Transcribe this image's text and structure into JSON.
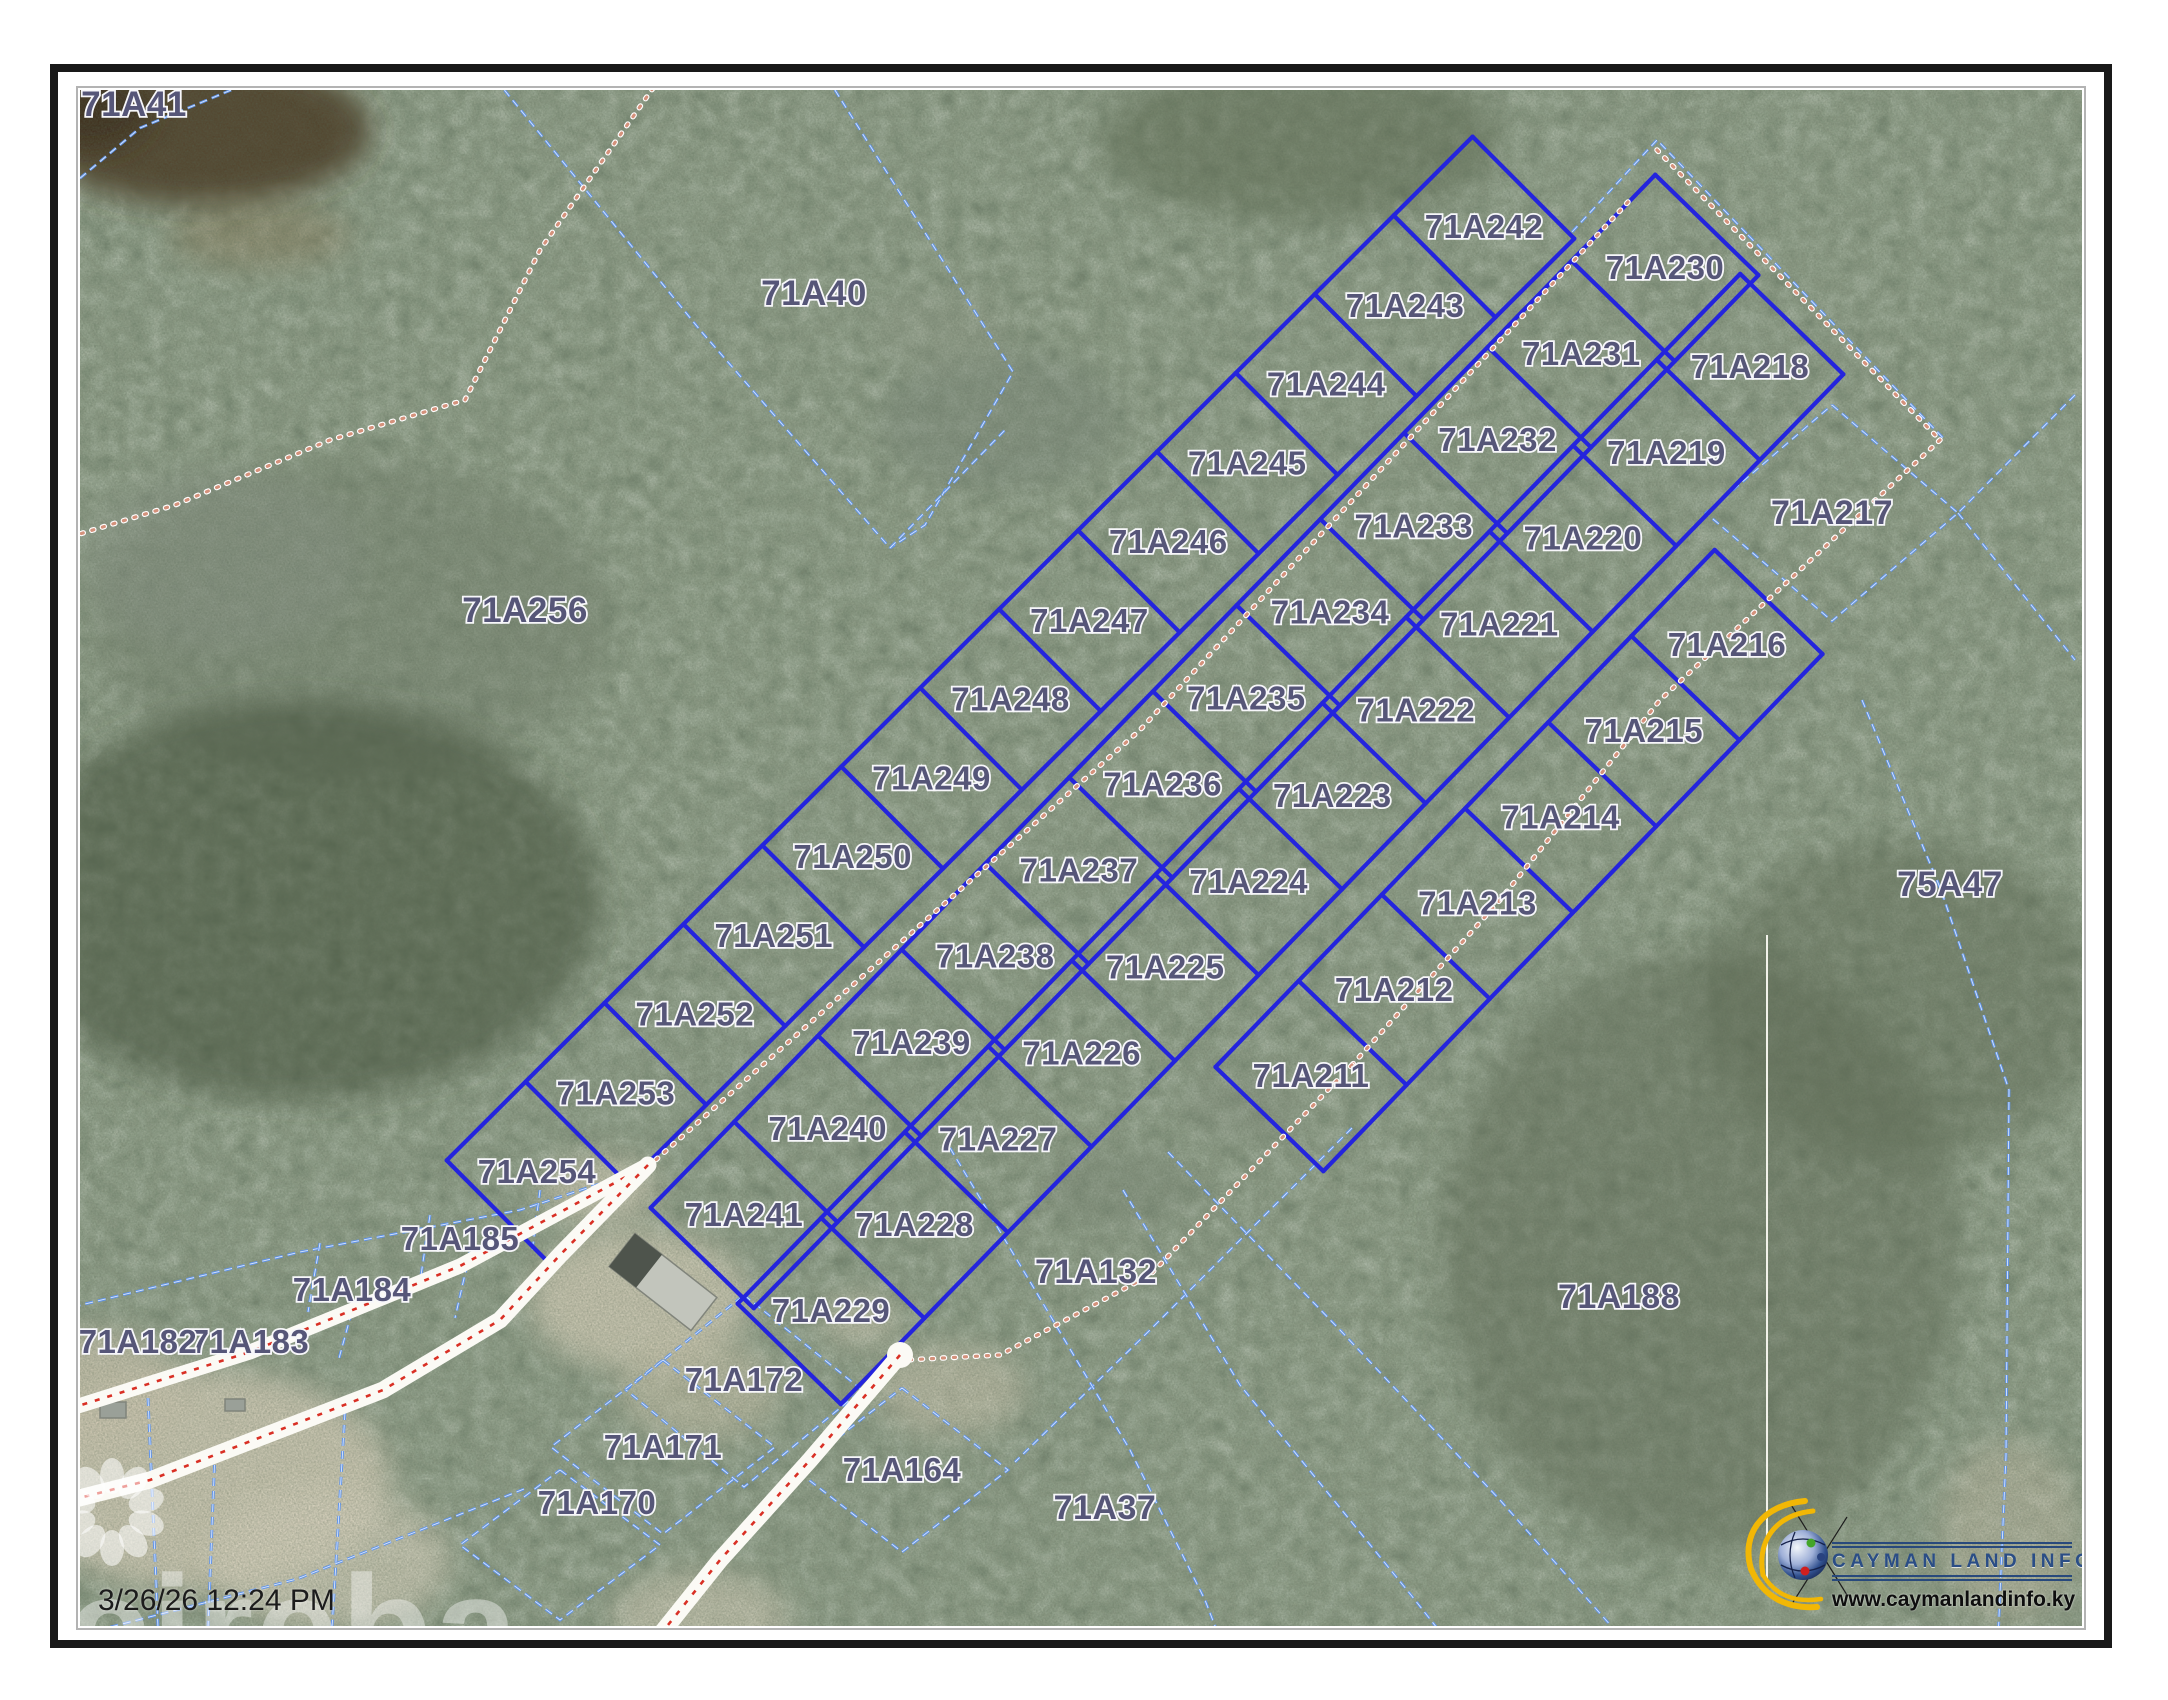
{
  "map": {
    "timestamp": "3/26/26 12:24 PM",
    "watermark_text": "cireba",
    "logo": {
      "title": "CAYMAN LAND INFO",
      "url": "www.caymanlandinfo.ky"
    },
    "colors": {
      "lot_line": "#2424dd",
      "cadastral_dash": "#5f93ea",
      "track_dot": "#d4917b",
      "road_center": "#d93025",
      "road_fill": "#fbfaf5",
      "label_fill": "#565678",
      "label_halo": "#f7f7fa",
      "vegetation_base": "#46513d",
      "white_section_line": "#f2f2ea"
    },
    "subdivision": {
      "columns": [
        {
          "ids": [
            "71A242",
            "71A243",
            "71A244",
            "71A245",
            "71A246",
            "71A247",
            "71A248",
            "71A249",
            "71A250",
            "71A251",
            "71A252",
            "71A253",
            "71A254"
          ],
          "start": [
            1484,
            227
          ],
          "end": [
            537,
            1172
          ],
          "halfWidth": 72
        },
        {
          "ids": [
            "71A230",
            "71A231",
            "71A232",
            "71A233",
            "71A234",
            "71A235",
            "71A236",
            "71A237",
            "71A238",
            "71A239",
            "71A240",
            "71A241"
          ],
          "start": [
            1665,
            268
          ],
          "end": [
            744,
            1215
          ],
          "halfWidth": 72
        },
        {
          "ids": [
            "71A218",
            "71A219",
            "71A220",
            "71A221",
            "71A222",
            "71A223",
            "71A224",
            "71A225",
            "71A226",
            "71A227",
            "71A228",
            "71A229"
          ],
          "start": [
            1750,
            367
          ],
          "end": [
            831,
            1311
          ],
          "halfWidth": 72
        },
        {
          "ids": [
            "71A216",
            "71A215",
            "71A214",
            "71A213",
            "71A212",
            "71A211"
          ],
          "start": [
            1727,
            645
          ],
          "end": [
            1311,
            1076
          ],
          "halfWidth": 75
        }
      ]
    },
    "parcels_static": [
      {
        "label": "71A41",
        "x": 134,
        "y": 105,
        "size": 35
      },
      {
        "label": "71A40",
        "x": 814,
        "y": 294,
        "size": 35
      },
      {
        "label": "71A256",
        "x": 525,
        "y": 611,
        "size": 35
      },
      {
        "label": "71A217",
        "x": 1832,
        "y": 513,
        "size": 34
      },
      {
        "label": "75A47",
        "x": 1950,
        "y": 885,
        "size": 35
      },
      {
        "label": "71A132",
        "x": 1096,
        "y": 1272,
        "size": 34
      },
      {
        "label": "71A188",
        "x": 1619,
        "y": 1297,
        "size": 34
      },
      {
        "label": "71A37",
        "x": 1105,
        "y": 1508,
        "size": 34
      },
      {
        "label": "71A185",
        "x": 460,
        "y": 1239,
        "size": 33
      },
      {
        "label": "71A184",
        "x": 352,
        "y": 1290,
        "size": 33
      },
      {
        "label": "71A183",
        "x": 250,
        "y": 1342,
        "size": 33
      },
      {
        "label": "71A182",
        "x": 138,
        "y": 1342,
        "size": 33
      },
      {
        "label": "71A172",
        "x": 744,
        "y": 1380,
        "size": 33
      },
      {
        "label": "71A171",
        "x": 663,
        "y": 1447,
        "size": 33
      },
      {
        "label": "71A170",
        "x": 597,
        "y": 1503,
        "size": 33
      },
      {
        "label": "71A164",
        "x": 902,
        "y": 1470,
        "size": 33
      }
    ],
    "boundaries_dashed": [
      [
        [
          60,
          195
        ],
        [
          140,
          128
        ],
        [
          260,
          78
        ],
        [
          370,
          60
        ]
      ],
      [
        [
          488,
          70
        ],
        [
          700,
          330
        ],
        [
          890,
          548
        ]
      ],
      [
        [
          821,
          68
        ],
        [
          1013,
          372
        ],
        [
          925,
          525
        ],
        [
          890,
          548
        ]
      ],
      [
        [
          890,
          548
        ],
        [
          1005,
          430
        ]
      ],
      [
        [
          1572,
          232
        ],
        [
          1657,
          140
        ],
        [
          1748,
          235
        ]
      ],
      [
        [
          1748,
          235
        ],
        [
          1945,
          440
        ]
      ],
      [
        [
          1832,
          405
        ],
        [
          1958,
          513
        ],
        [
          1832,
          621
        ],
        [
          1706,
          513
        ],
        [
          1832,
          405
        ]
      ],
      [
        [
          2075,
          395
        ],
        [
          1958,
          513
        ]
      ],
      [
        [
          1958,
          513
        ],
        [
          2075,
          660
        ]
      ],
      [
        [
          1862,
          700
        ],
        [
          1941,
          890
        ],
        [
          2009,
          1090
        ],
        [
          2006,
          1455
        ],
        [
          1998,
          1640
        ]
      ],
      [
        [
          1352,
          1128
        ],
        [
          1150,
          1330
        ],
        [
          1015,
          1462
        ]
      ],
      [
        [
          1123,
          1190
        ],
        [
          1240,
          1385
        ],
        [
          1411,
          1595
        ],
        [
          1478,
          1680
        ]
      ],
      [
        [
          1168,
          1152
        ],
        [
          1340,
          1330
        ],
        [
          1500,
          1500
        ],
        [
          1650,
          1670
        ]
      ],
      [
        [
          950,
          1148
        ],
        [
          1035,
          1290
        ],
        [
          1130,
          1450
        ],
        [
          1205,
          1600
        ],
        [
          1230,
          1665
        ]
      ],
      [
        [
          524,
          1489
        ],
        [
          297,
          1579
        ],
        [
          60,
          1640
        ]
      ],
      [
        [
          215,
          1452
        ],
        [
          208,
          1628
        ]
      ],
      [
        [
          345,
          1412
        ],
        [
          332,
          1628
        ]
      ],
      [
        [
          148,
          1398
        ],
        [
          158,
          1628
        ]
      ],
      [
        [
          744,
          1295
        ],
        [
          862,
          1390
        ],
        [
          744,
          1487
        ],
        [
          626,
          1390
        ],
        [
          744,
          1295
        ]
      ],
      [
        [
          663,
          1360
        ],
        [
          775,
          1447
        ],
        [
          663,
          1534
        ],
        [
          551,
          1447
        ],
        [
          663,
          1360
        ]
      ],
      [
        [
          560,
          1470
        ],
        [
          660,
          1545
        ],
        [
          560,
          1620
        ],
        [
          460,
          1545
        ],
        [
          560,
          1470
        ]
      ],
      [
        [
          902,
          1388
        ],
        [
          1008,
          1470
        ],
        [
          902,
          1552
        ],
        [
          796,
          1470
        ],
        [
          902,
          1388
        ]
      ],
      [
        [
          60,
          1310
        ],
        [
          300,
          1252
        ],
        [
          520,
          1210
        ],
        [
          648,
          1168
        ]
      ],
      [
        [
          320,
          1243
        ],
        [
          308,
          1312
        ]
      ],
      [
        [
          430,
          1215
        ],
        [
          420,
          1282
        ]
      ],
      [
        [
          540,
          1190
        ],
        [
          532,
          1252
        ]
      ],
      [
        [
          355,
          1300
        ],
        [
          338,
          1362
        ]
      ],
      [
        [
          470,
          1252
        ],
        [
          455,
          1318
        ]
      ]
    ],
    "tracks_dotted": [
      [
        [
          653,
          88
        ],
        [
          540,
          250
        ],
        [
          465,
          400
        ],
        [
          330,
          440
        ],
        [
          175,
          505
        ],
        [
          60,
          540
        ]
      ],
      [
        [
          1628,
          202
        ],
        [
          1140,
          730
        ],
        [
          650,
          1165
        ]
      ],
      [
        [
          1657,
          150
        ],
        [
          1940,
          440
        ]
      ],
      [
        [
          1940,
          440
        ],
        [
          1660,
          700
        ],
        [
          1500,
          900
        ],
        [
          1352,
          1065
        ]
      ],
      [
        [
          1352,
          1065
        ],
        [
          1150,
          1275
        ],
        [
          1000,
          1355
        ],
        [
          905,
          1360
        ]
      ]
    ],
    "roads": [
      {
        "points": [
          [
            648,
            1165
          ],
          [
            460,
            1266
          ],
          [
            250,
            1352
          ],
          [
            40,
            1418
          ]
        ],
        "width": 15
      },
      {
        "points": [
          [
            648,
            1165
          ],
          [
            560,
            1255
          ],
          [
            500,
            1320
          ],
          [
            383,
            1390
          ],
          [
            150,
            1480
          ],
          [
            40,
            1508
          ]
        ],
        "width": 17
      },
      {
        "points": [
          [
            900,
            1355
          ],
          [
            810,
            1460
          ],
          [
            720,
            1560
          ],
          [
            640,
            1660
          ],
          [
            612,
            1700
          ]
        ],
        "width": 17,
        "bulb": [
          900,
          1355
        ]
      }
    ],
    "terrain_blobs": [
      {
        "cx": 200,
        "cy": 130,
        "rx": 170,
        "ry": 75,
        "fill": "#4e3e28",
        "op": 0.9
      },
      {
        "cx": 90,
        "cy": 110,
        "rx": 60,
        "ry": 40,
        "fill": "#3c2f1e",
        "op": 0.9
      },
      {
        "cx": 260,
        "cy": 235,
        "rx": 90,
        "ry": 32,
        "fill": "#8a7a58",
        "op": 0.45
      },
      {
        "cx": 350,
        "cy": 620,
        "rx": 260,
        "ry": 160,
        "fill": "#77836f",
        "op": 0.5
      },
      {
        "cx": 220,
        "cy": 560,
        "rx": 140,
        "ry": 90,
        "fill": "#8d978a",
        "op": 0.45
      },
      {
        "cx": 1000,
        "cy": 420,
        "rx": 120,
        "ry": 70,
        "fill": "#7c887a",
        "op": 0.45
      },
      {
        "cx": 940,
        "cy": 330,
        "rx": 70,
        "ry": 40,
        "fill": "#97a08e",
        "op": 0.4
      },
      {
        "cx": 1300,
        "cy": 140,
        "rx": 200,
        "ry": 80,
        "fill": "#5b6950",
        "op": 0.5
      },
      {
        "cx": 300,
        "cy": 900,
        "rx": 300,
        "ry": 200,
        "fill": "#39452f",
        "op": 0.5
      },
      {
        "cx": 200,
        "cy": 1480,
        "rx": 190,
        "ry": 110,
        "fill": "#d6cfba",
        "op": 0.85
      },
      {
        "cx": 90,
        "cy": 1390,
        "rx": 90,
        "ry": 60,
        "fill": "#cfc8b2",
        "op": 0.8
      },
      {
        "cx": 330,
        "cy": 1560,
        "rx": 120,
        "ry": 70,
        "fill": "#d9d3bf",
        "op": 0.7
      },
      {
        "cx": 640,
        "cy": 1300,
        "rx": 110,
        "ry": 70,
        "fill": "#d3cdb8",
        "op": 0.85
      },
      {
        "cx": 700,
        "cy": 1390,
        "rx": 80,
        "ry": 50,
        "fill": "#cfc8b0",
        "op": 0.6
      },
      {
        "cx": 600,
        "cy": 1190,
        "rx": 60,
        "ry": 35,
        "fill": "#d6cfba",
        "op": 0.7
      },
      {
        "cx": 950,
        "cy": 1390,
        "rx": 75,
        "ry": 45,
        "fill": "#d0c9b4",
        "op": 0.6
      },
      {
        "cx": 860,
        "cy": 1320,
        "rx": 40,
        "ry": 25,
        "fill": "#d6cfba",
        "op": 0.6
      },
      {
        "cx": 700,
        "cy": 1620,
        "rx": 90,
        "ry": 50,
        "fill": "#d9d2bd",
        "op": 0.6
      },
      {
        "cx": 1120,
        "cy": 1190,
        "rx": 80,
        "ry": 40,
        "fill": "#7f8b79",
        "op": 0.45
      },
      {
        "cx": 1240,
        "cy": 1110,
        "rx": 60,
        "ry": 35,
        "fill": "#8a9483",
        "op": 0.4
      },
      {
        "cx": 1700,
        "cy": 1250,
        "rx": 260,
        "ry": 300,
        "fill": "#5f6b55",
        "op": 0.45
      },
      {
        "cx": 1900,
        "cy": 1000,
        "rx": 200,
        "ry": 160,
        "fill": "#5a6650",
        "op": 0.4
      },
      {
        "cx": 2010,
        "cy": 1530,
        "rx": 70,
        "ry": 90,
        "fill": "#c9c2ac",
        "op": 0.5
      }
    ],
    "buildings": [
      {
        "cx": 663,
        "cy": 1282,
        "w": 104,
        "h": 42,
        "rot": 38,
        "fill": "#c2c5bc",
        "dark": "#4e544c"
      },
      {
        "cx": 113,
        "cy": 1410,
        "w": 26,
        "h": 16,
        "rot": 0,
        "fill": "#9aa098"
      },
      {
        "cx": 235,
        "cy": 1405,
        "w": 20,
        "h": 12,
        "rot": 0,
        "fill": "#9aa098"
      }
    ],
    "white_line": {
      "x": 1767,
      "y1": 935,
      "y2": 1582
    }
  }
}
